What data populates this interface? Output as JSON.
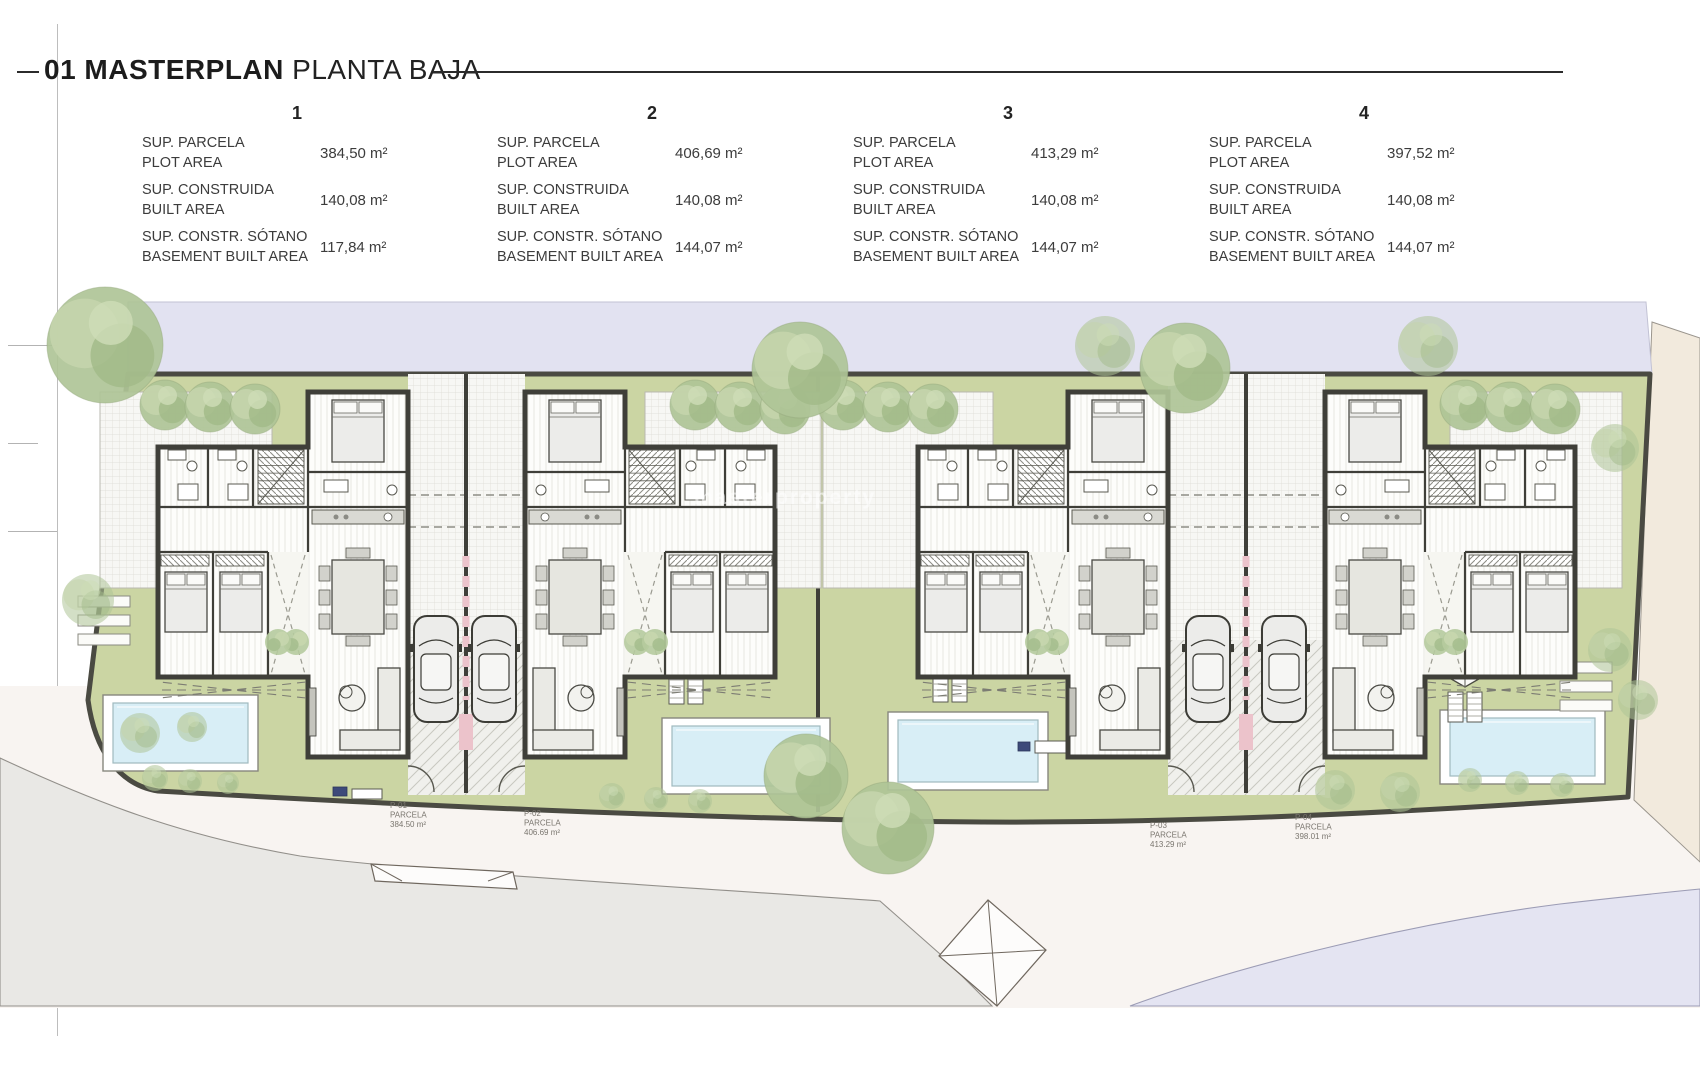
{
  "title": {
    "number_bold": "01 MASTERPLAN",
    "regular": "PLANTA BAJA"
  },
  "tables": {
    "row_labels": [
      {
        "es": "SUP. PARCELA",
        "en": "PLOT AREA"
      },
      {
        "es": "SUP. CONSTRUIDA",
        "en": "BUILT AREA"
      },
      {
        "es": "SUP. CONSTR. SÓTANO",
        "en": "BASEMENT BUILT AREA"
      }
    ],
    "units": [
      {
        "number": "1",
        "values": [
          "384,50 m²",
          "140,08 m²",
          "117,84 m²"
        ]
      },
      {
        "number": "2",
        "values": [
          "406,69 m²",
          "140,08 m²",
          "144,07 m²"
        ]
      },
      {
        "number": "3",
        "values": [
          "413,29 m²",
          "140,08 m²",
          "144,07 m²"
        ]
      },
      {
        "number": "4",
        "values": [
          "397,52 m²",
          "140,08 m²",
          "144,07 m²"
        ]
      }
    ]
  },
  "plan": {
    "watermark": "masterproperty",
    "parcels": [
      {
        "code": "P-01",
        "kind": "PARCELA",
        "area": "384.50 m²"
      },
      {
        "code": "P-02",
        "kind": "PARCELA",
        "area": "406.69 m²"
      },
      {
        "code": "P-03",
        "kind": "PARCELA",
        "area": "413.29 m²"
      },
      {
        "code": "P-04",
        "kind": "PARCELA",
        "area": "398.01 m²"
      }
    ]
  },
  "colors": {
    "lavender": "#e2e2f1",
    "site_green": "#cbd5a3",
    "boundary": "#4a4a42",
    "road": "#f8f4f1",
    "gray_wedge": "#e9e8e5",
    "beige": "#f2eadd",
    "pool": "#d8eef6",
    "pink": "#ecc3cb",
    "wall": "#3f3f39",
    "tree": "#b1c79a"
  }
}
